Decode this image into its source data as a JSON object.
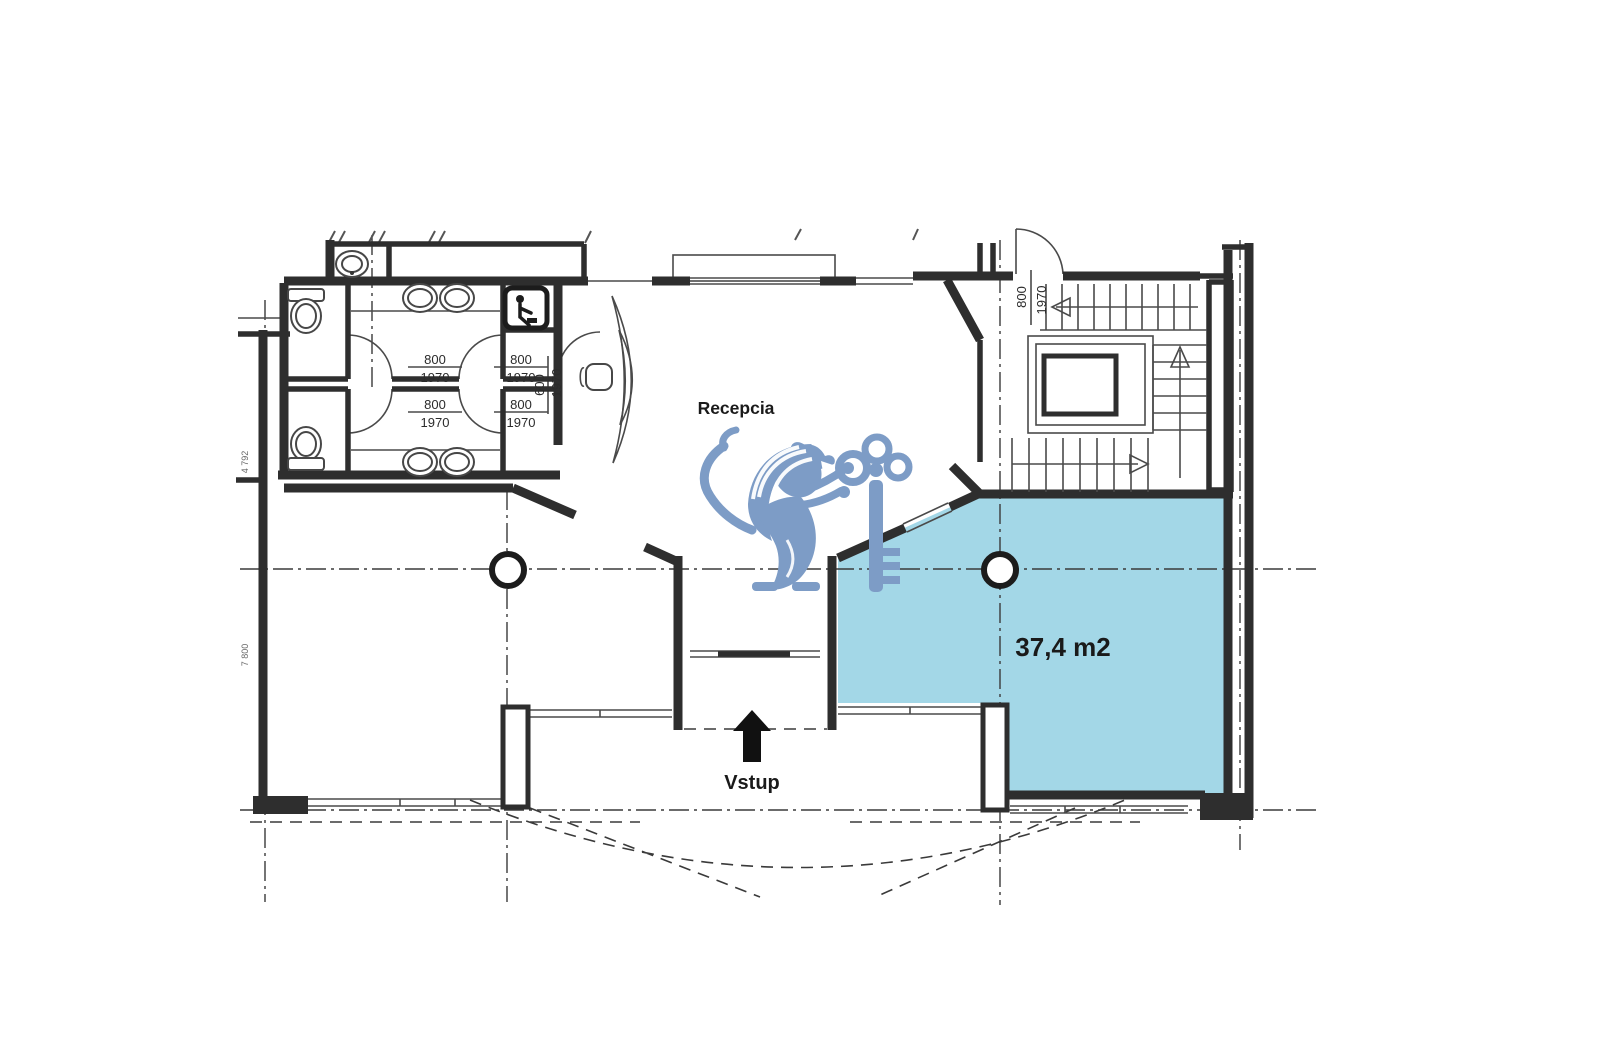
{
  "labels": {
    "reception": "Recepcia",
    "area": "37,4 m2",
    "entrance": "Vstup"
  },
  "dimensions": {
    "door_width": "800",
    "door_height": "1970",
    "wide_door_width": "600",
    "side_dim_upper": "4 792",
    "side_dim_lower": "7 800"
  },
  "colors": {
    "highlight_room": "#a3d7e7",
    "watermark": "#7d9cc6",
    "walls": "#2e2e2e",
    "area_label": "#1f2d3d"
  }
}
